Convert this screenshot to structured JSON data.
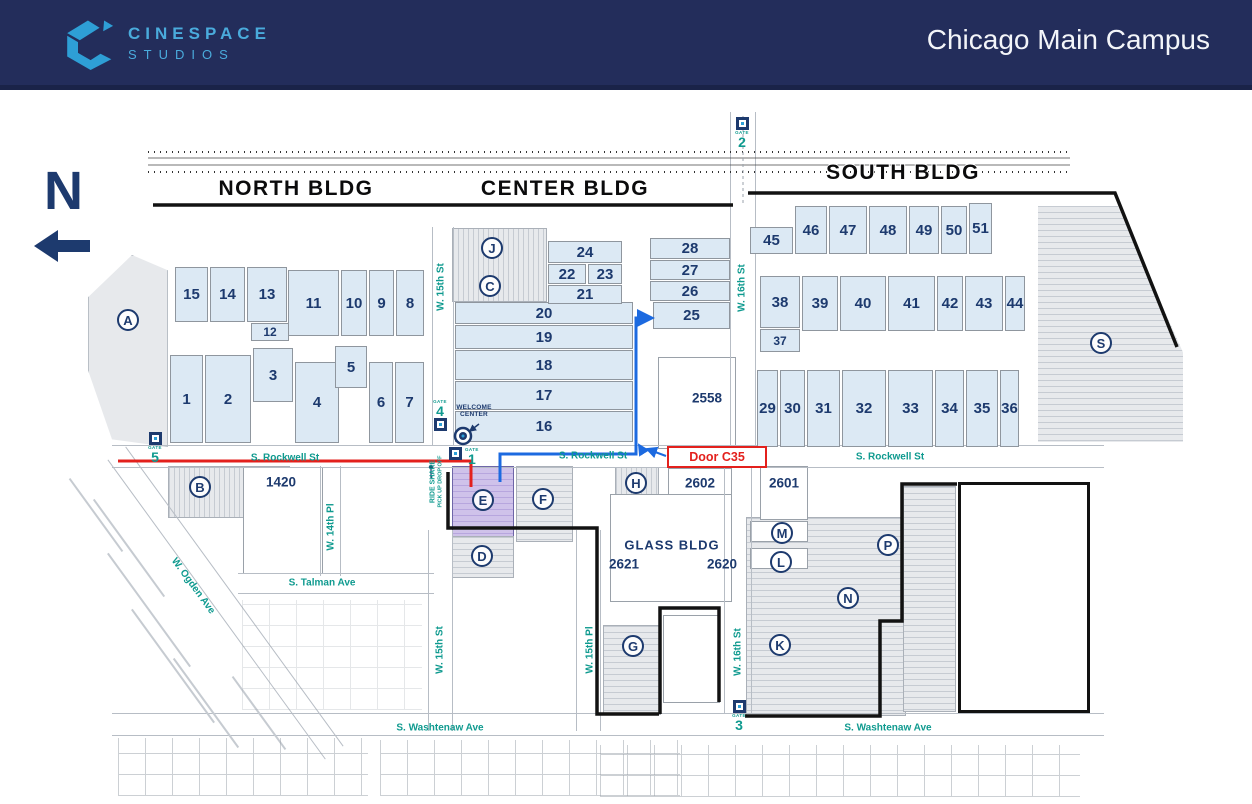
{
  "header": {
    "brand_line1": "CINESPACE",
    "brand_line2": "STUDIOS",
    "title": "Chicago Main Campus"
  },
  "map": {
    "north_letter": "N",
    "gate_word": "GATE",
    "glass_label": "GLASS BLDG",
    "door_label": "Door C35",
    "welcome_lines": [
      "WELCOME",
      "CENTER"
    ],
    "rideshare_lines": [
      "RIDE SHARE",
      "PICK UP DROP OFF"
    ],
    "building_headers": [
      {
        "label": "NORTH BLDG",
        "x": 296,
        "y": 189
      },
      {
        "label": "CENTER  BLDG",
        "x": 565,
        "y": 189
      },
      {
        "label": "SOUTH BLDG",
        "x": 903,
        "y": 173
      }
    ],
    "stages": [
      {
        "n": "1",
        "x": 170,
        "y": 355,
        "w": 33,
        "h": 88
      },
      {
        "n": "2",
        "x": 205,
        "y": 355,
        "w": 46,
        "h": 88
      },
      {
        "n": "3",
        "x": 253,
        "y": 348,
        "w": 40,
        "h": 54
      },
      {
        "n": "4",
        "x": 295,
        "y": 362,
        "w": 44,
        "h": 81
      },
      {
        "n": "5",
        "x": 335,
        "y": 346,
        "w": 32,
        "h": 42
      },
      {
        "n": "6",
        "x": 369,
        "y": 362,
        "w": 24,
        "h": 81
      },
      {
        "n": "7",
        "x": 395,
        "y": 362,
        "w": 29,
        "h": 81
      },
      {
        "n": "8",
        "x": 396,
        "y": 270,
        "w": 28,
        "h": 66
      },
      {
        "n": "9",
        "x": 369,
        "y": 270,
        "w": 25,
        "h": 66
      },
      {
        "n": "10",
        "x": 341,
        "y": 270,
        "w": 26,
        "h": 66
      },
      {
        "n": "11",
        "x": 288,
        "y": 270,
        "w": 51,
        "h": 66
      },
      {
        "n": "12",
        "x": 251,
        "y": 323,
        "w": 38,
        "h": 18,
        "sm": true
      },
      {
        "n": "13",
        "x": 247,
        "y": 267,
        "w": 40,
        "h": 55
      },
      {
        "n": "14",
        "x": 210,
        "y": 267,
        "w": 35,
        "h": 55
      },
      {
        "n": "15",
        "x": 175,
        "y": 267,
        "w": 33,
        "h": 55
      },
      {
        "n": "16",
        "x": 455,
        "y": 411,
        "w": 178,
        "h": 31
      },
      {
        "n": "17",
        "x": 455,
        "y": 381,
        "w": 178,
        "h": 29
      },
      {
        "n": "18",
        "x": 455,
        "y": 350,
        "w": 178,
        "h": 30
      },
      {
        "n": "19",
        "x": 455,
        "y": 325,
        "w": 178,
        "h": 24
      },
      {
        "n": "20",
        "x": 455,
        "y": 302,
        "w": 178,
        "h": 22
      },
      {
        "n": "21",
        "x": 548,
        "y": 285,
        "w": 74,
        "h": 19
      },
      {
        "n": "22",
        "x": 548,
        "y": 264,
        "w": 38,
        "h": 20
      },
      {
        "n": "23",
        "x": 588,
        "y": 264,
        "w": 34,
        "h": 20
      },
      {
        "n": "24",
        "x": 548,
        "y": 241,
        "w": 74,
        "h": 22
      },
      {
        "n": "25",
        "x": 653,
        "y": 302,
        "w": 77,
        "h": 27,
        "variant": "purple"
      },
      {
        "n": "26",
        "x": 650,
        "y": 281,
        "w": 80,
        "h": 20
      },
      {
        "n": "27",
        "x": 650,
        "y": 260,
        "w": 80,
        "h": 20
      },
      {
        "n": "28",
        "x": 650,
        "y": 238,
        "w": 80,
        "h": 21
      },
      {
        "n": "29",
        "x": 757,
        "y": 370,
        "w": 21,
        "h": 77
      },
      {
        "n": "30",
        "x": 780,
        "y": 370,
        "w": 25,
        "h": 77
      },
      {
        "n": "31",
        "x": 807,
        "y": 370,
        "w": 33,
        "h": 77
      },
      {
        "n": "32",
        "x": 842,
        "y": 370,
        "w": 44,
        "h": 77
      },
      {
        "n": "33",
        "x": 888,
        "y": 370,
        "w": 45,
        "h": 77
      },
      {
        "n": "34",
        "x": 935,
        "y": 370,
        "w": 29,
        "h": 77
      },
      {
        "n": "35",
        "x": 966,
        "y": 370,
        "w": 32,
        "h": 77
      },
      {
        "n": "36",
        "x": 1000,
        "y": 370,
        "w": 19,
        "h": 77
      },
      {
        "n": "37",
        "x": 760,
        "y": 329,
        "w": 40,
        "h": 23,
        "sm": true
      },
      {
        "n": "38",
        "x": 760,
        "y": 276,
        "w": 40,
        "h": 52
      },
      {
        "n": "39",
        "x": 802,
        "y": 276,
        "w": 36,
        "h": 55
      },
      {
        "n": "40",
        "x": 840,
        "y": 276,
        "w": 46,
        "h": 55
      },
      {
        "n": "41",
        "x": 888,
        "y": 276,
        "w": 47,
        "h": 55
      },
      {
        "n": "42",
        "x": 937,
        "y": 276,
        "w": 26,
        "h": 55
      },
      {
        "n": "43",
        "x": 965,
        "y": 276,
        "w": 38,
        "h": 55
      },
      {
        "n": "44",
        "x": 1005,
        "y": 276,
        "w": 20,
        "h": 55
      },
      {
        "n": "45",
        "x": 750,
        "y": 227,
        "w": 43,
        "h": 27
      },
      {
        "n": "46",
        "x": 795,
        "y": 206,
        "w": 32,
        "h": 48
      },
      {
        "n": "47",
        "x": 829,
        "y": 206,
        "w": 38,
        "h": 48
      },
      {
        "n": "48",
        "x": 869,
        "y": 206,
        "w": 38,
        "h": 48
      },
      {
        "n": "49",
        "x": 909,
        "y": 206,
        "w": 30,
        "h": 48
      },
      {
        "n": "50",
        "x": 941,
        "y": 206,
        "w": 26,
        "h": 48
      },
      {
        "n": "51",
        "x": 969,
        "y": 203,
        "w": 23,
        "h": 51
      }
    ],
    "lots": [
      {
        "label": "A",
        "x": 128,
        "y": 320
      },
      {
        "label": "B",
        "x": 200,
        "y": 487
      },
      {
        "label": "C",
        "x": 490,
        "y": 286
      },
      {
        "label": "D",
        "x": 482,
        "y": 556
      },
      {
        "label": "E",
        "x": 483,
        "y": 500
      },
      {
        "label": "F",
        "x": 543,
        "y": 499
      },
      {
        "label": "G",
        "x": 633,
        "y": 646
      },
      {
        "label": "H",
        "x": 636,
        "y": 483
      },
      {
        "label": "J",
        "x": 492,
        "y": 248
      },
      {
        "label": "K",
        "x": 780,
        "y": 645
      },
      {
        "label": "L",
        "x": 781,
        "y": 562
      },
      {
        "label": "M",
        "x": 782,
        "y": 533
      },
      {
        "label": "N",
        "x": 848,
        "y": 598
      },
      {
        "label": "P",
        "x": 888,
        "y": 545
      },
      {
        "label": "S",
        "x": 1101,
        "y": 343
      }
    ],
    "streets": [
      {
        "label": "S. Rockwell St",
        "x": 285,
        "y": 458,
        "r": 0
      },
      {
        "label": "S. Rockwell St",
        "x": 593,
        "y": 456,
        "r": 0
      },
      {
        "label": "S. Rockwell St",
        "x": 890,
        "y": 457,
        "r": 0
      },
      {
        "label": "S. Talman Ave",
        "x": 322,
        "y": 583,
        "r": 0
      },
      {
        "label": "S. Washtenaw Ave",
        "x": 440,
        "y": 728,
        "r": 0
      },
      {
        "label": "S. Washtenaw Ave",
        "x": 888,
        "y": 728,
        "r": 0
      },
      {
        "label": "W. Ogden Ave",
        "x": 193,
        "y": 586,
        "r": 54
      },
      {
        "label": "W. 14th Pl",
        "x": 331,
        "y": 527,
        "r": -90
      },
      {
        "label": "W. 15th St",
        "x": 441,
        "y": 287,
        "r": -90
      },
      {
        "label": "W. 15th St",
        "x": 440,
        "y": 650,
        "r": -90
      },
      {
        "label": "W. 15th Pl",
        "x": 590,
        "y": 650,
        "r": -90
      },
      {
        "label": "W. 16th St",
        "x": 742,
        "y": 288,
        "r": -90
      },
      {
        "label": "W. 16th St",
        "x": 738,
        "y": 652,
        "r": -90
      }
    ],
    "gates": [
      {
        "n": "1",
        "x": 449,
        "y": 449,
        "dir": "right"
      },
      {
        "n": "2",
        "x": 735,
        "y": 117,
        "dir": "below"
      },
      {
        "n": "3",
        "x": 732,
        "y": 700,
        "dir": "below"
      },
      {
        "n": "4",
        "x": 433,
        "y": 425,
        "dir": "above"
      },
      {
        "n": "5",
        "x": 148,
        "y": 432,
        "dir": "below"
      }
    ],
    "addresses": [
      {
        "label": "1420",
        "x": 281,
        "y": 482
      },
      {
        "label": "2558",
        "x": 707,
        "y": 398
      },
      {
        "label": "2602",
        "x": 700,
        "y": 483
      },
      {
        "label": "2601",
        "x": 784,
        "y": 483
      },
      {
        "label": "2621",
        "x": 624,
        "y": 564
      },
      {
        "label": "2620",
        "x": 722,
        "y": 564
      }
    ],
    "routes": {
      "red": "118,461 471,461 471,487",
      "blue": "500,482 500,454 636,454 636,318 652,318",
      "blue_door_label_arrow": "666,456 647,449",
      "blue_wall_arrow": "644,453 639,445"
    },
    "route_colors": {
      "red": "#e3201c",
      "blue": "#1c6ae0"
    }
  }
}
